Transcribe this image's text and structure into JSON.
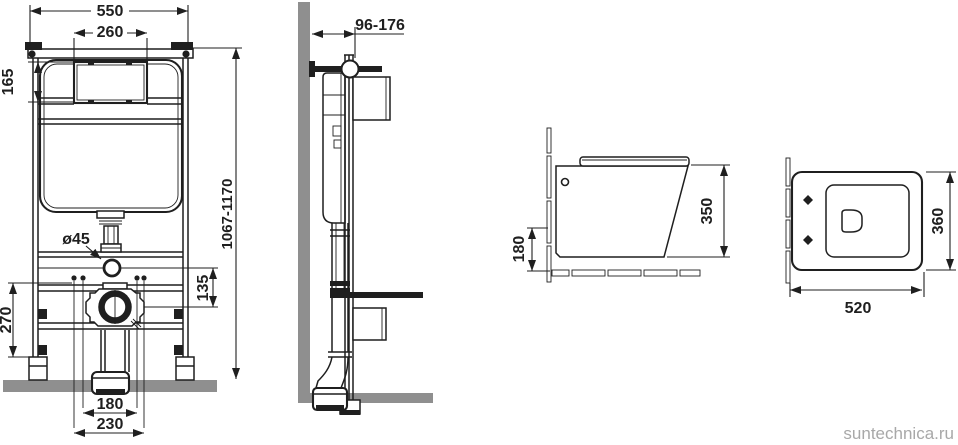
{
  "drawing_title": "Wall-hung toilet installation set — dimensional drawing",
  "colors": {
    "ink": "#1f1f1f",
    "wall_floor_gray": "#8f8f8f",
    "watermark_gray": "#a8a8a8",
    "background": "#ffffff"
  },
  "watermark": "suntechnica.ru",
  "views": {
    "frame_front": {
      "name": "installation frame front view",
      "dims": {
        "overall_width": "550",
        "cutout_width": "260",
        "cutout_height": "165",
        "frame_height_range": "1067-1170",
        "flush_pipe_diameter": "ø45",
        "flush_to_drain_offset": "135",
        "lower_zone_height": "270",
        "stud_spacing_inner": "180",
        "stud_spacing_outer": "230"
      }
    },
    "frame_side": {
      "name": "installation frame side view",
      "dims": {
        "depth_range": "96-176"
      }
    },
    "bowl_side": {
      "name": "toilet bowl side view",
      "dims": {
        "bowl_height": "350",
        "floor_clearance": "180"
      }
    },
    "bowl_top": {
      "name": "toilet bowl top view",
      "dims": {
        "bowl_length": "520",
        "bowl_width": "360"
      }
    }
  }
}
